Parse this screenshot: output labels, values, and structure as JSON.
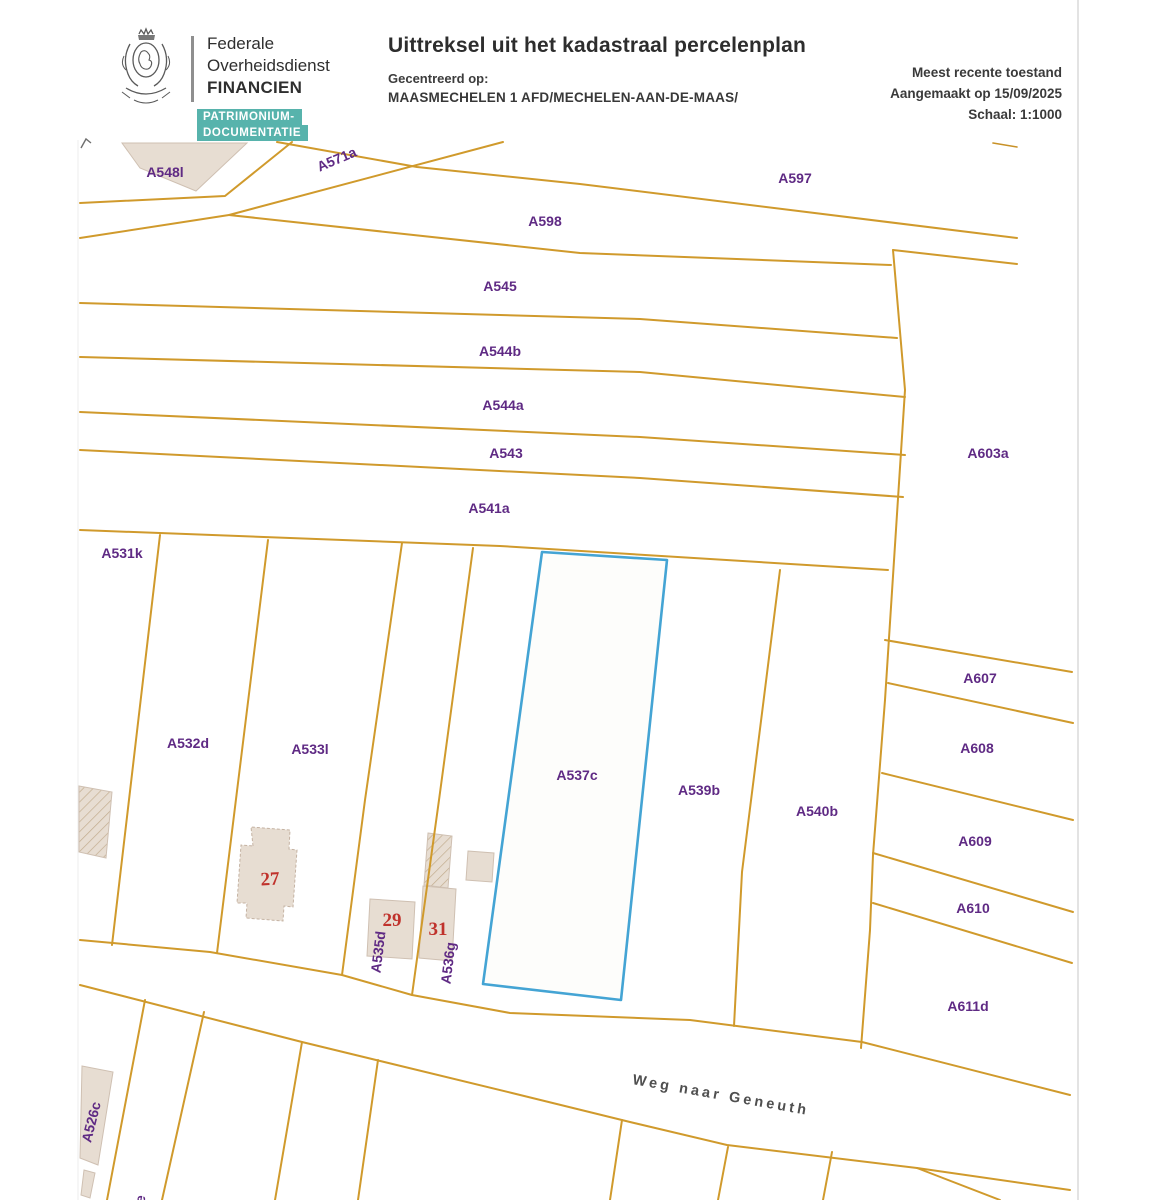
{
  "header": {
    "org": {
      "line1": "Federale",
      "line2": "Overheidsdienst",
      "line3": "FINANCIEN"
    },
    "badge": {
      "line1": "PATRIMONIUM-",
      "line2": "DOCUMENTATIE",
      "color": "#57b3ac"
    },
    "title": "Uittreksel uit het kadastraal percelenplan",
    "centered_label": "Gecentreerd op:",
    "centered_value": "MAASMECHELEN 1 AFD/MECHELEN-AAN-DE-MAAS/",
    "meta": {
      "recency": "Meest recente toestand",
      "created": "Aangemaakt op 15/09/2025",
      "scale": "Schaal: 1:1000"
    }
  },
  "map": {
    "street_name": "Weg naar Geneuth",
    "highlighted_parcel": "A537c",
    "scale": "1:1000",
    "house_numbers": {
      "h27": "27",
      "h29": "29",
      "h31": "31"
    },
    "labels": {
      "a548l": "A548l",
      "a571a": "A571a",
      "a597": "A597",
      "a598": "A598",
      "a545": "A545",
      "a544b": "A544b",
      "a544a": "A544a",
      "a543": "A543",
      "a541a": "A541a",
      "a603a": "A603a",
      "a531k": "A531k",
      "a532d": "A532d",
      "a533l": "A533l",
      "a537c": "A537c",
      "a539b": "A539b",
      "a540b": "A540b",
      "a607": "A607",
      "a608": "A608",
      "a609": "A609",
      "a610": "A610",
      "a611d": "A611d",
      "a535d": "A535d",
      "a536g": "A536g",
      "a526c": "A526c",
      "partial_bottom": "e"
    },
    "colors": {
      "boundary": "#d09a2c",
      "highlight_border": "#44a4d4",
      "parcel_label": "#5f2a84",
      "house_number": "#c0322c",
      "building_fill": "#e7ddd2",
      "street_text": "#4f4f4f"
    }
  }
}
